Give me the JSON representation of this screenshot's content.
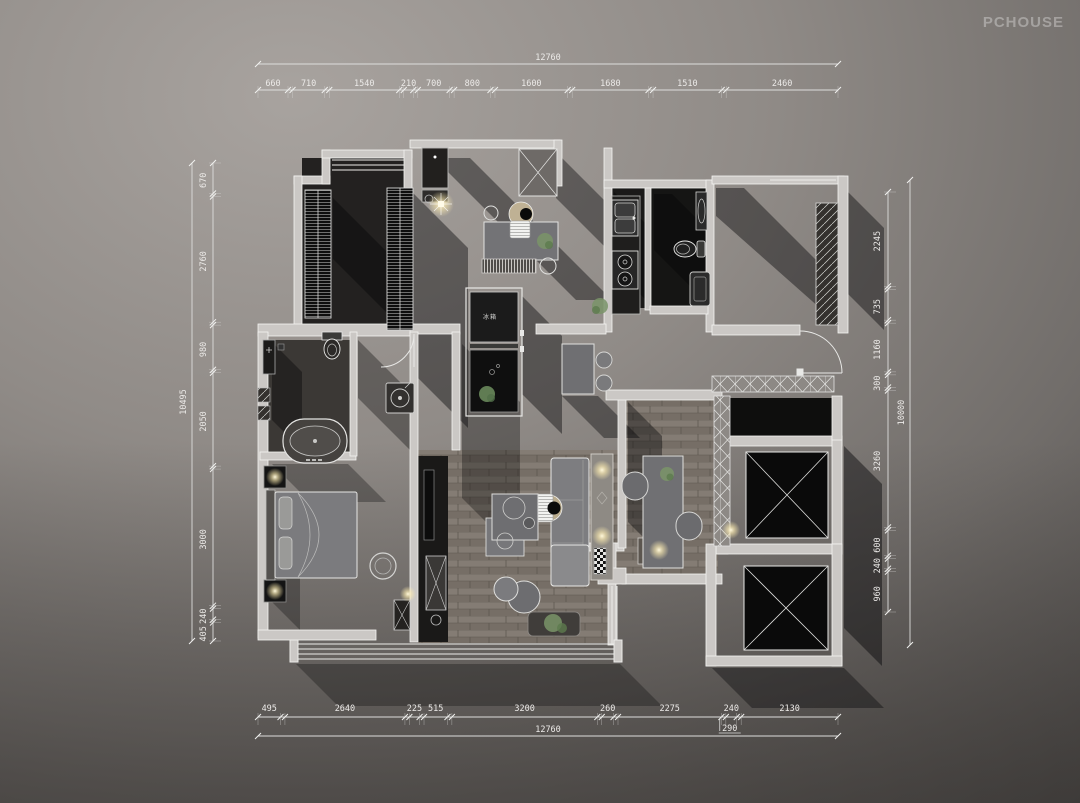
{
  "watermark": "PCHOUSE",
  "plan": {
    "fridge_label": "冰箱"
  },
  "dimensions": {
    "top": {
      "total": "12760",
      "segments": [
        "660",
        "710",
        "1540",
        "210",
        "700",
        "800",
        "1600",
        "1680",
        "1510",
        "2460"
      ]
    },
    "bottom": {
      "total": "12760",
      "segments": [
        "495",
        "2640",
        "225",
        "515",
        "3200",
        "260",
        "2275",
        "240",
        "2130"
      ],
      "extra": "290"
    },
    "left": {
      "total": "10495",
      "segments": [
        "670",
        "2760",
        "980",
        "2050",
        "3000",
        "240",
        "405"
      ]
    },
    "right": {
      "total": "10000",
      "segments": [
        "2245",
        "735",
        "1160",
        "300",
        "3260",
        "600",
        "240",
        "960"
      ]
    }
  }
}
